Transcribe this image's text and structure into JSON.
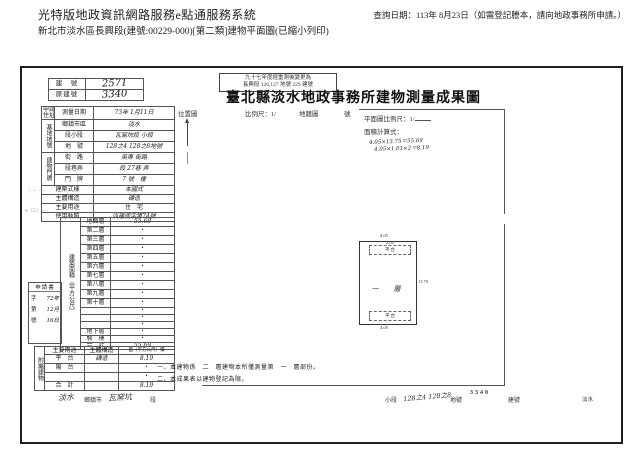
{
  "header": {
    "system_title": "光特版地政資訊網路服務e點通服務系統",
    "query_date": "查詢日期：113年 8月23日（如需登記謄本，請向地政事務所申請。）",
    "doc_line": "新北市淡水區長興段(建號:00229-000)[第二類]建物平面圖(已縮小列印)"
  },
  "stamp_box": {
    "line1": "九十七年度經重測後變更為",
    "line2": "長興段 126,127 地號 229 建號"
  },
  "building_no": {
    "label1": "建　號",
    "value1": "2571",
    "label2": "原建號",
    "value2": "3340"
  },
  "doc_title": "臺北縣淡水地政事務所建物測量成果圖",
  "location_bar": {
    "location": "位置圖",
    "scale": "比例尺：1/",
    "cadastre": "地籍圖",
    "sheet": "號"
  },
  "form": {
    "applicant_label": "申請人",
    "applicant_label2": "住址",
    "survey_date_label": "測量日期",
    "survey_date_value": "73年 1月11日",
    "site_group": "基地地號",
    "site_rows": [
      {
        "label": "鄉鎮市區",
        "value": "淡水"
      },
      {
        "label": "段小段",
        "value": "瓦窯坑段 小段"
      },
      {
        "label": "地　號",
        "value": "128之4 128之8地號"
      }
    ],
    "door_group": "建物門牌",
    "door_rows": [
      {
        "label": "街　路",
        "value": "英專 街路"
      },
      {
        "label": "段巷弄",
        "value": "段 27巷 弄"
      },
      {
        "label": "門　牌",
        "value": "7 號　樓"
      }
    ],
    "attr_rows": [
      {
        "label": "建築式樣",
        "value": "本國式"
      },
      {
        "label": "主體構造",
        "value": "磚造"
      },
      {
        "label": "主要用途",
        "value": "住　宅"
      },
      {
        "label": "使用執照",
        "value": "淡建使字第74號"
      }
    ],
    "area_group": "建築面積（平方公尺）",
    "floor_rows": [
      {
        "label": "地面層",
        "value": "55.69"
      },
      {
        "label": "第二層",
        "value": "・"
      },
      {
        "label": "第三層",
        "value": "・"
      },
      {
        "label": "第四層",
        "value": "・"
      },
      {
        "label": "第五層",
        "value": "・"
      },
      {
        "label": "第六層",
        "value": "・"
      },
      {
        "label": "第七層",
        "value": "・"
      },
      {
        "label": "第八層",
        "value": "・"
      },
      {
        "label": "第九層",
        "value": "・"
      },
      {
        "label": "第十層",
        "value": "・"
      },
      {
        "label": "",
        "value": "・"
      },
      {
        "label": "",
        "value": "・"
      },
      {
        "label": "",
        "value": "・"
      },
      {
        "label": "地下層",
        "value": "・"
      },
      {
        "label": "騎　樓",
        "value": "・"
      },
      {
        "label": "合　計",
        "value": "55.69"
      }
    ]
  },
  "application_box": {
    "title": "申請書",
    "row1_p": "字",
    "row1_v": "72年",
    "row2_p": "第",
    "row2_v": "12月",
    "row3_p": "號",
    "row3_v": "16日"
  },
  "annex": {
    "group": "附屬建物",
    "header": {
      "use": "主要用途",
      "structure": "主體構造",
      "area": "面（平方公尺）積"
    },
    "rows": [
      {
        "use": "平　台",
        "structure": "磚造",
        "area": "8.19"
      },
      {
        "use": "陽　台",
        "structure": "",
        "area": "・"
      },
      {
        "use": "",
        "structure": "",
        "area": "・"
      },
      {
        "use": "合　計",
        "structure": "",
        "area": "8.19"
      }
    ]
  },
  "plan": {
    "scale_label": "平面圖比例尺：1/",
    "calc_label": "面積計算式：",
    "calc_line1": "4.05×13.75＝55.69",
    "calc_line2": "4.05×1.01×2＝8.19",
    "floor_label": "一　層",
    "terrace_top": "平 台",
    "terrace_bottom": "平 台",
    "dim_top": "4.05",
    "dim_top_small": "2.02",
    "dim_right": "13.75",
    "dim_bottom": "4.05"
  },
  "notes": {
    "line1": "一、本建物係　二　層建物本所僅測量第　一　層部份。",
    "line2": "二、本成果表以建物登記為限。"
  },
  "footer": {
    "district_hand": "淡水",
    "district": "鄉鎮市",
    "section_hand": "瓦窯坑",
    "section": "段",
    "subsection": "小段",
    "parcel_hand": "128之4 128之8",
    "parcel": "地號",
    "building_no": "3340",
    "building_no_label": "建號",
    "right_mark": "淡水"
  },
  "margin_marks": {
    "m1": "（一）──",
    "m2": "●（三）──"
  }
}
